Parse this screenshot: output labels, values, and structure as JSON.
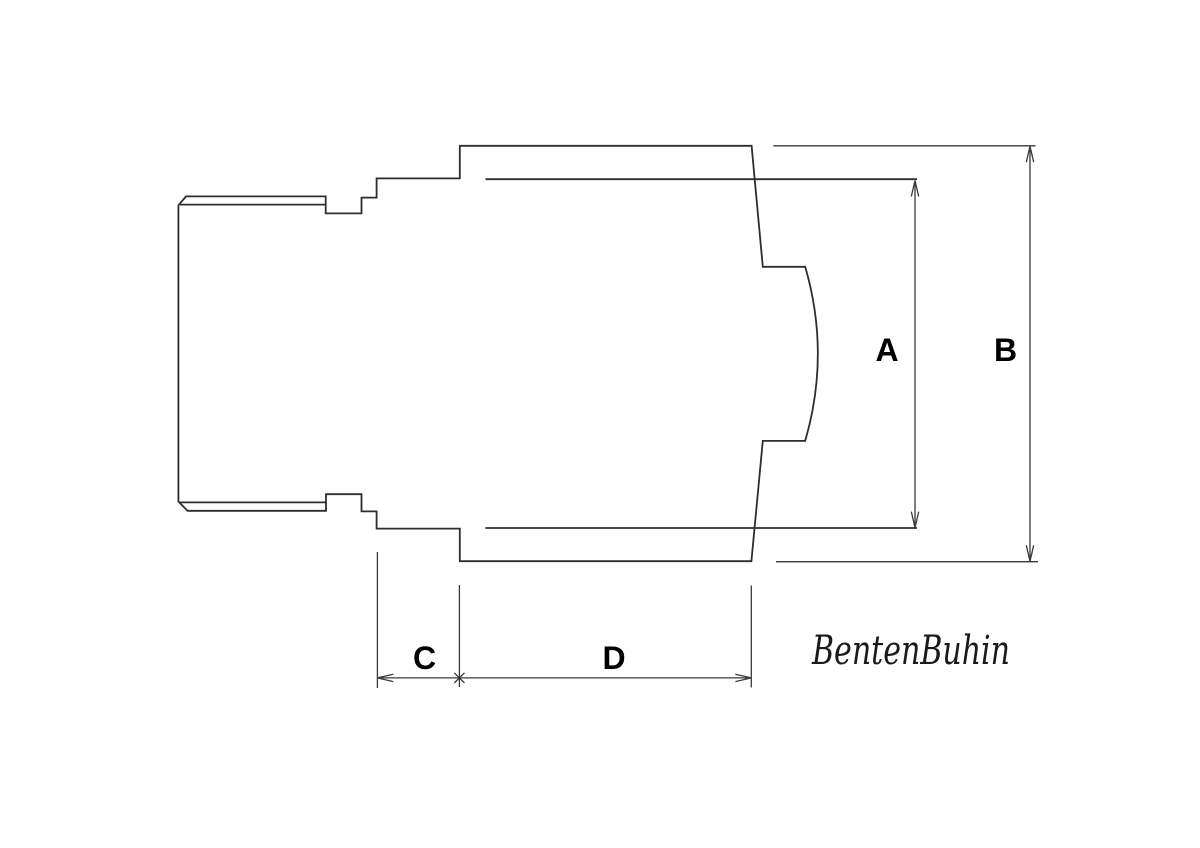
{
  "drawing": {
    "kind": "technical line drawing, side cross-section of a cap/fitting part",
    "dimension_labels": {
      "a": "A",
      "b": "B",
      "c": "C",
      "d": "D"
    },
    "logo": {
      "text": "BentenBuhin"
    },
    "colors": {
      "background": "#ffffff",
      "outline": "#2d2d2d",
      "dimension": "#3a3a3a",
      "label": "#000000",
      "logo": "#1a1a1a"
    }
  }
}
